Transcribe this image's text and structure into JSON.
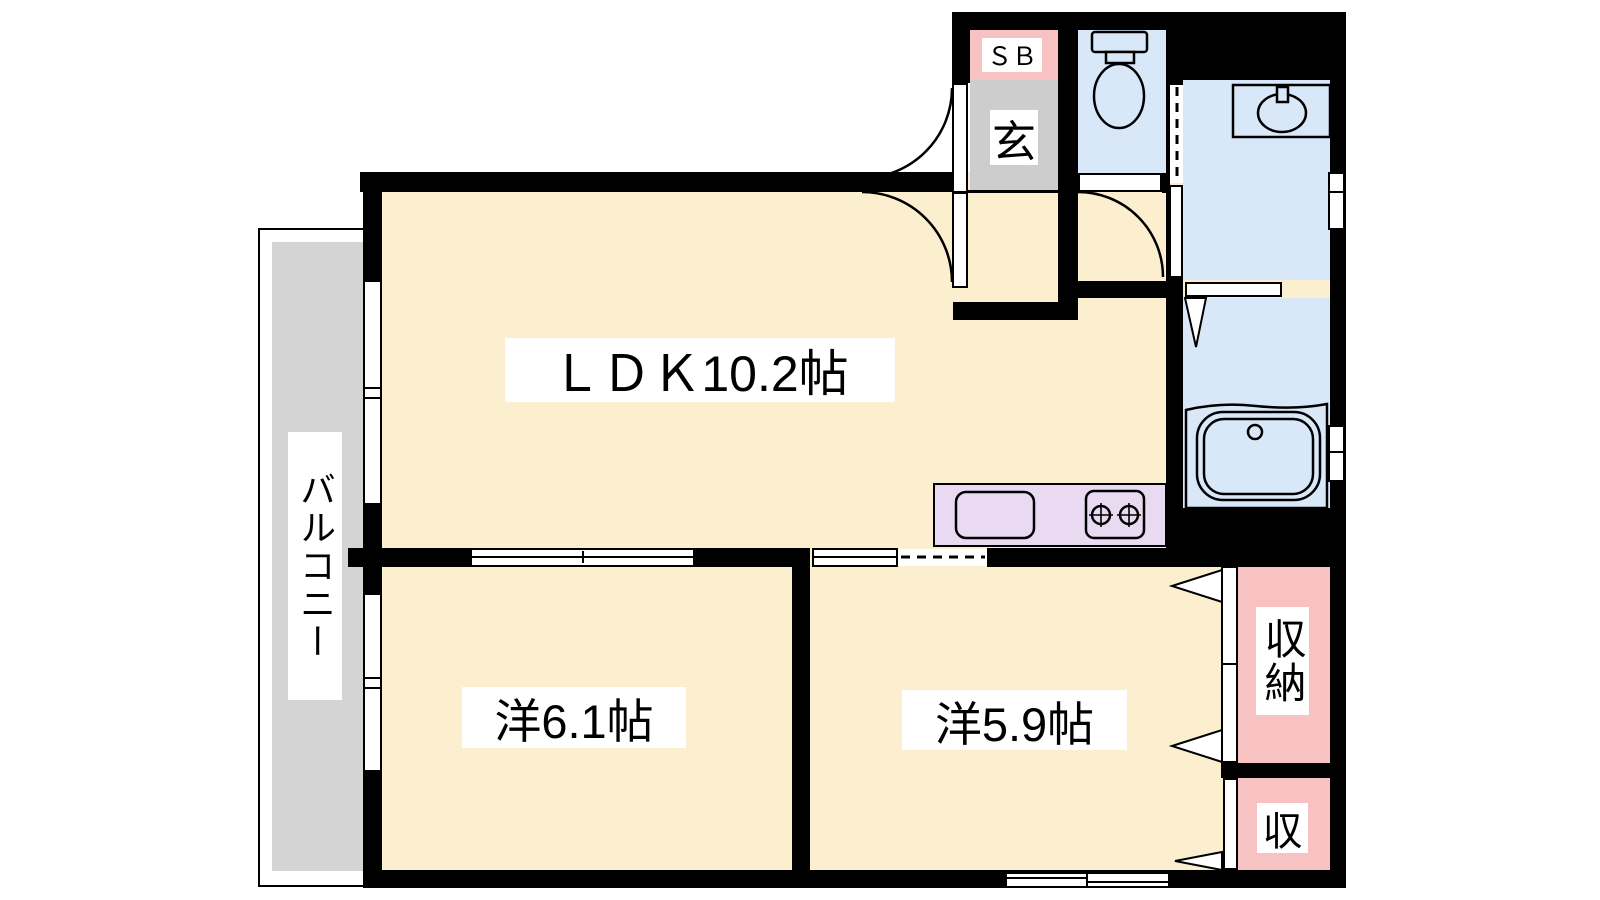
{
  "floorplan": {
    "title": "1LDK apartment floor plan",
    "rooms": {
      "ldk": {
        "label": "ＬＤＫ10.2帖"
      },
      "bedroom1": {
        "label": "洋6.1帖"
      },
      "bedroom2": {
        "label": "洋5.9帖"
      },
      "balcony": {
        "label": "バルコニー"
      },
      "entrance": {
        "label": "玄"
      },
      "shoe_box": {
        "label": "ＳＢ"
      },
      "closet_large": {
        "label": "収納"
      },
      "closet_small": {
        "label": "収"
      }
    },
    "fixtures": [
      "toilet",
      "washbasin",
      "bathtub",
      "kitchen-sink",
      "gas-stove"
    ],
    "colors": {
      "room_cream": "#fcefd0",
      "wet_area_blue": "#d9e8f8",
      "closet_pink": "#f9c2c2",
      "balcony_gray": "#d4d4d4",
      "entrance_gray": "#cdcdcd",
      "kitchen_purple": "#e9daf2",
      "wall_black": "#000000",
      "label_bg": "#ffffff"
    }
  }
}
